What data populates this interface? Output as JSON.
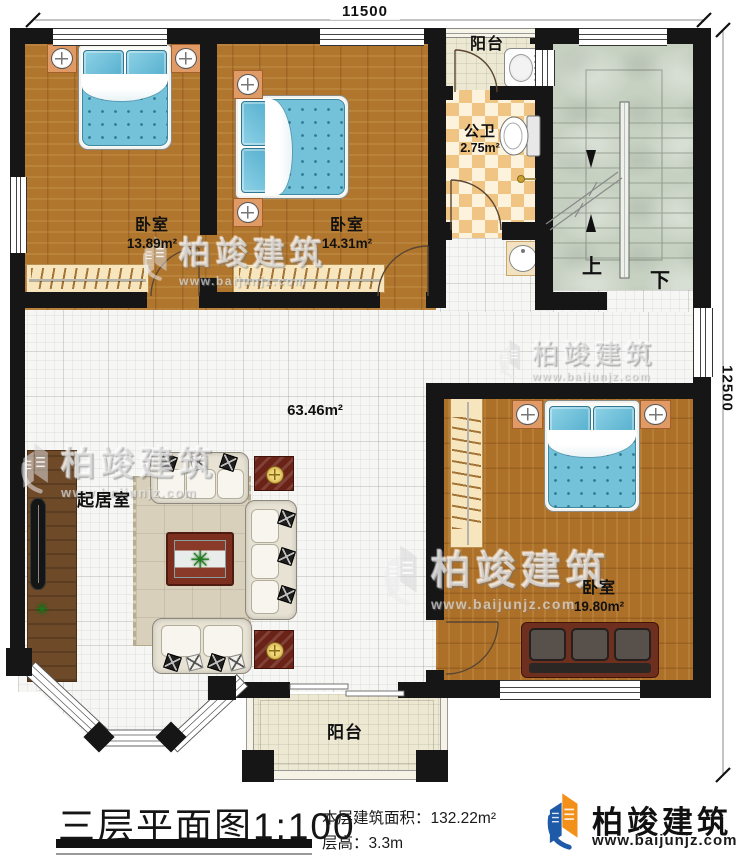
{
  "dimensions": {
    "top": "11500",
    "right": "12500"
  },
  "rooms": {
    "bedroom1": {
      "name": "卧室",
      "area": "13.89m²"
    },
    "bedroom2": {
      "name": "卧室",
      "area": "14.31m²"
    },
    "bedroom3": {
      "name": "卧室",
      "area": "19.80m²"
    },
    "living": {
      "name": "起居室",
      "area": "63.46m²"
    },
    "bathroom": {
      "name": "公卫",
      "area": "2.75m²"
    },
    "balcony_top": {
      "name": "阳台"
    },
    "balcony_bottom": {
      "name": "阳台"
    }
  },
  "stairs": {
    "up": "上",
    "down": "下"
  },
  "title": {
    "plan": "三层平面图",
    "scale": "1:100",
    "area_label": "本层建筑面积：",
    "area_value": "132.22m²",
    "floor_height_label": "层高：",
    "floor_height_value": "3.3m"
  },
  "brand": {
    "name": "柏竣建筑",
    "url": "www.baijunjz.com"
  },
  "watermark": {
    "name": "柏竣建筑",
    "url": "www.baijunjz.com"
  },
  "icons": {
    "plant": "✳"
  },
  "colors": {
    "wall": "#161616",
    "wood": "#b1762d",
    "bed": "#74c2da",
    "checker": "#f0c482",
    "stair": "#c7d1c2",
    "balcony": "#ebe7d1",
    "brand_blue": "#1e5aa8",
    "brand_orange": "#f39019"
  }
}
